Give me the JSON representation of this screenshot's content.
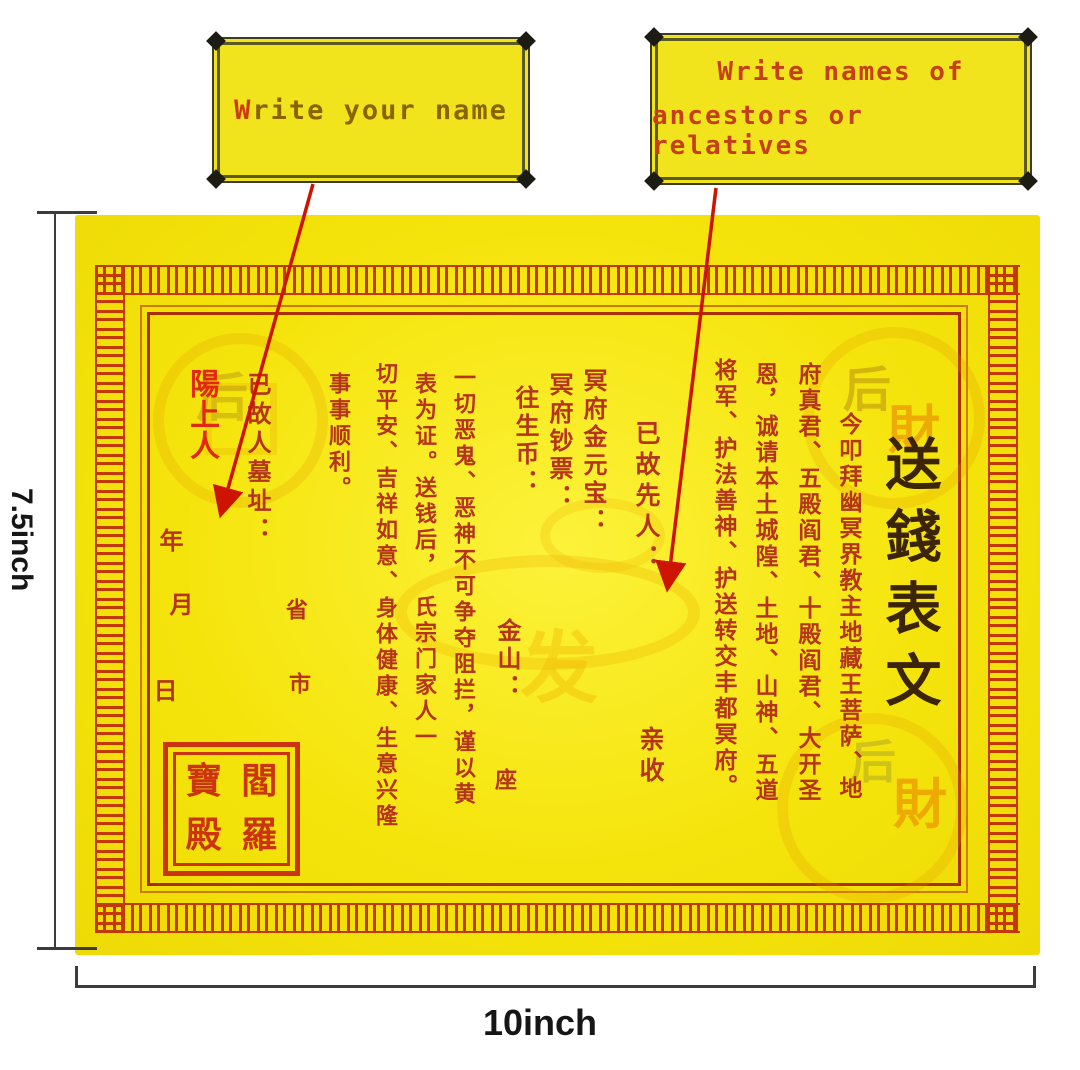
{
  "colors": {
    "paper_yellow": "#f5e40c",
    "callout_yellow": "#f2e41c",
    "border_red": "#c43808",
    "frame_orange": "#cf7a00",
    "frame_red": "#a93008",
    "body_text_red": "#b5341c",
    "title_ink": "#3b2506",
    "living_red": "#e22810",
    "seal_red": "#cc3410",
    "arrow_red": "#cc1400",
    "dimension_line": "#3c3c3c",
    "callout_text_left": "#8a6400",
    "callout_text_right": "#c54018"
  },
  "callout_left": {
    "first_letter": "W",
    "rest": "rite your name"
  },
  "callout_right": {
    "line1": "Write names of",
    "line2": "ancestors or relatives"
  },
  "dimensions": {
    "height_label": "7.5inch",
    "width_label": "10inch"
  },
  "paper": {
    "title": "送錢表文",
    "invocation": [
      "今叩拜幽冥界教主地藏王菩萨、地",
      "府真君、五殿阎君、十殿阎君、大开圣",
      "恩，诚请本土城隍、土地、山神、五道",
      "将军、护法善神、护送转交丰都冥府。"
    ],
    "deceased_label": "已故先人：",
    "receive_label": "亲收",
    "offerings": [
      "冥府金元宝：",
      "冥府钞票：",
      "往生币："
    ],
    "gold_mountain_label": "金山：",
    "seat_label": "座",
    "vow": [
      "一切恶鬼、恶神不可争夺阻拦，谨以黄",
      "表为证。送钱后，　氏宗门家人一",
      "切平安、吉祥如意、身体健康、生意兴隆",
      "事事顺利。"
    ],
    "grave_label": "已故人墓址：",
    "living_label": "陽上人",
    "province_label": "省",
    "city_label": "市",
    "year_label": "年",
    "month_label": "月",
    "day_label": "日",
    "seal": {
      "top_left": "寶",
      "top_right": "閻",
      "bottom_left": "殿",
      "bottom_right": "羅"
    },
    "watermarks": {
      "tl_coin": "后",
      "tr_coin_top": "后",
      "tr_coin_bottom": "財",
      "br_coin_top": "后",
      "br_coin_bottom": "財",
      "center": "发"
    }
  }
}
